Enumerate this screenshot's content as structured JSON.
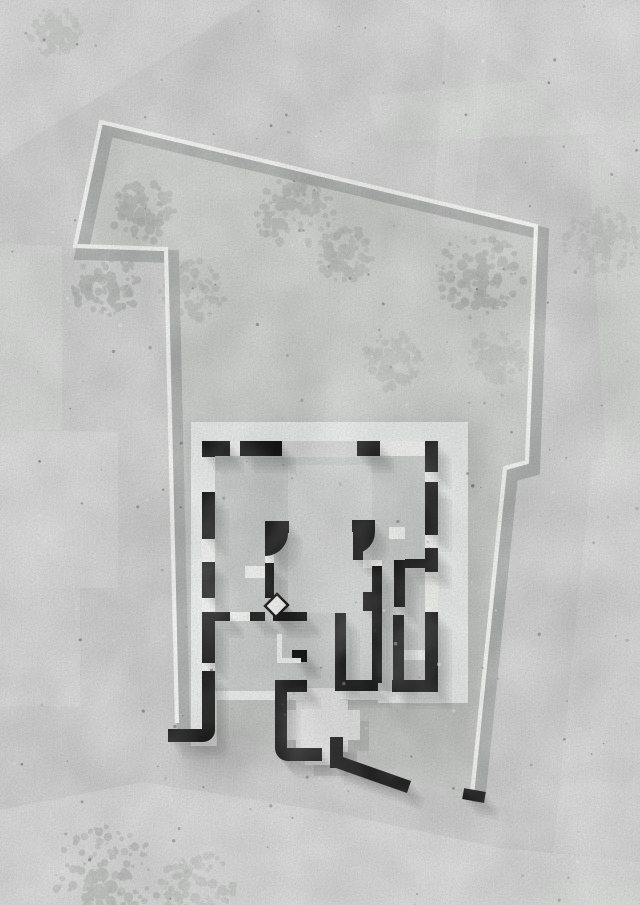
{
  "canvas": {
    "width": 640,
    "height": 905
  },
  "palette": {
    "paper": "#d0d1d0",
    "patch": "#dcdddc",
    "site_tint": "#c5c7c6",
    "halo": "#9e9f9e",
    "tree": "#a4a8a5",
    "tree_dark": "#8f938f",
    "boundary": "#f7f7f5",
    "boundary_shadow": "#a7a9a8",
    "slab": "#ebecec",
    "room": "#c7c9c8",
    "room_light": "#d2d4d3",
    "porch": "#d4d5d4",
    "wall": "#161616",
    "shadow": "#3a3b3a",
    "white": "#f2f2f1",
    "terrace": "#e3e4e3",
    "speckle_dark": "#3a3a3a",
    "speckle_light": "#ffffff"
  },
  "ground": {
    "base": {
      "name": "ground-base"
    },
    "patches": [
      {
        "name": "patch-top-left-plate",
        "pts": "0,0 255,0 0,158",
        "opacity": 0.7
      },
      {
        "name": "patch-top-right-plate",
        "pts": "400,0 640,0 640,195 520,72",
        "opacity": 0.55
      },
      {
        "name": "patch-road-vertical",
        "pts": "447,0 493,0 472,232 432,226",
        "opacity": 0.5
      },
      {
        "name": "patch-road-horizontal",
        "pts": "368,96 640,70 640,132 382,142",
        "opacity": 0.45
      },
      {
        "name": "patch-left-1",
        "pts": "0,244 62,246 62,430 0,430",
        "opacity": 0.6
      },
      {
        "name": "patch-left-2",
        "pts": "0,430 118,432 118,588 0,588",
        "opacity": 0.7
      },
      {
        "name": "patch-left-3",
        "pts": "0,588 80,588 80,706 0,706",
        "opacity": 0.5
      },
      {
        "name": "patch-right-mid",
        "pts": "588,140 640,118 640,450 606,460",
        "opacity": 0.45
      },
      {
        "name": "patch-right-low",
        "pts": "592,460 640,452 640,905 548,905",
        "opacity": 0.5
      },
      {
        "name": "patch-bottom-sweep",
        "pts": "0,810 143,782 330,812 500,848 640,862 640,905 0,905",
        "opacity": 0.8
      },
      {
        "name": "patch-bottom-band",
        "pts": "210,838 640,884 640,905 480,905 196,858",
        "opacity": 0.45
      }
    ]
  },
  "site": {
    "tint_points": "101,122 536,226 527,462 505,468 472,795 177,723 166,249 75,246",
    "tint_opacity": 0.22,
    "halo": {
      "name": "building-ground-halo",
      "r": [
        180,
        425,
        305,
        345
      ],
      "opacity": 0.32
    }
  },
  "trees": [
    {
      "name": "tree-1",
      "cx": 143,
      "cy": 211,
      "r": 33,
      "opacity": 0.5,
      "seed": 11
    },
    {
      "name": "tree-2",
      "cx": 295,
      "cy": 213,
      "r": 40,
      "opacity": 0.45,
      "seed": 23
    },
    {
      "name": "tree-3",
      "cx": 343,
      "cy": 253,
      "r": 30,
      "opacity": 0.4,
      "seed": 31
    },
    {
      "name": "tree-4",
      "cx": 480,
      "cy": 276,
      "r": 45,
      "opacity": 0.5,
      "seed": 47
    },
    {
      "name": "tree-5",
      "cx": 106,
      "cy": 283,
      "r": 36,
      "opacity": 0.5,
      "seed": 53
    },
    {
      "name": "tree-6",
      "cx": 193,
      "cy": 291,
      "r": 33,
      "opacity": 0.38,
      "seed": 61
    },
    {
      "name": "tree-7",
      "cx": 393,
      "cy": 362,
      "r": 31,
      "opacity": 0.32,
      "seed": 71
    },
    {
      "name": "tree-8",
      "cx": 495,
      "cy": 358,
      "r": 29,
      "opacity": 0.28,
      "seed": 83
    },
    {
      "name": "tree-9",
      "cx": 600,
      "cy": 245,
      "r": 38,
      "opacity": 0.22,
      "seed": 97
    },
    {
      "name": "tree-10",
      "cx": 107,
      "cy": 878,
      "r": 54,
      "opacity": 0.42,
      "seed": 101
    },
    {
      "name": "tree-11",
      "cx": 55,
      "cy": 33,
      "r": 26,
      "opacity": 0.22,
      "seed": 113
    },
    {
      "name": "tree-12",
      "cx": 198,
      "cy": 888,
      "r": 38,
      "opacity": 0.3,
      "seed": 127
    }
  ],
  "boundary": {
    "points": "177,723 166,249 75,246 101,122 536,226 527,462 505,468 472,795",
    "width": 4.2,
    "shadow_width": 13,
    "shadow_dx": 6.5,
    "shadow_dy": 7.5,
    "shadow_opacity": 0.85
  },
  "plan": {
    "slabs": [
      {
        "name": "slab-main",
        "r": [
          191,
          422,
          277,
          278
        ]
      },
      {
        "name": "slab-left-extension",
        "r": [
          191,
          694,
          26,
          52
        ]
      },
      {
        "name": "slab-bottom-extension",
        "r": [
          378,
          691,
          90,
          12
        ]
      }
    ],
    "rooms": [
      {
        "name": "interior-floor",
        "r": [
          215,
          456,
          210,
          235
        ],
        "fill": "room",
        "opacity": 1
      },
      {
        "name": "courtyard-floor",
        "r": [
          288,
          465,
          84,
          148
        ],
        "fill": "room_light",
        "opacity": 0.85
      },
      {
        "name": "corridor-floor",
        "r": [
          346,
          613,
          26,
          68
        ],
        "fill": "room_light",
        "opacity": 0.7
      },
      {
        "name": "entry-porch-floor",
        "r": [
          282,
          441,
          75,
          16
        ],
        "fill": "porch",
        "opacity": 1
      }
    ],
    "openings": [
      {
        "name": "window-top-1",
        "r": [
          230,
          441,
          10,
          15
        ]
      },
      {
        "name": "window-top-2",
        "r": [
          380,
          441,
          45,
          15
        ]
      },
      {
        "name": "window-left-1",
        "r": [
          202,
          539,
          13,
          23
        ]
      },
      {
        "name": "window-left-2",
        "r": [
          202,
          598,
          13,
          14
        ]
      },
      {
        "name": "window-left-3",
        "r": [
          202,
          663,
          13,
          8
        ]
      },
      {
        "name": "window-right-1",
        "r": [
          425,
          472,
          13,
          10
        ]
      },
      {
        "name": "window-right-2",
        "r": [
          425,
          535,
          13,
          13
        ]
      },
      {
        "name": "window-right-3",
        "r": [
          425,
          572,
          13,
          40
        ]
      },
      {
        "name": "door-gap-h4",
        "r": [
          230,
          612,
          20,
          9
        ]
      },
      {
        "name": "floor-band-left",
        "r": [
          245,
          566,
          20,
          12
        ]
      },
      {
        "name": "door-gap-v1",
        "r": [
          265,
          553,
          9,
          10
        ]
      },
      {
        "name": "door-gap-v2",
        "r": [
          363,
          560,
          19,
          8
        ]
      },
      {
        "name": "floor-band-right",
        "r": [
          404,
          650,
          21,
          10
        ]
      },
      {
        "name": "door-gap-h2",
        "r": [
          389,
          527,
          16,
          12
        ]
      }
    ],
    "terrace": [
      {
        "name": "terrace-core",
        "r": [
          296,
          700,
          52,
          52
        ]
      },
      {
        "name": "terrace-arm-vertical",
        "r": [
          305,
          688,
          35,
          77
        ]
      },
      {
        "name": "terrace-arm-horizontal",
        "r": [
          284,
          710,
          76,
          30
        ]
      }
    ],
    "terrace_shadow": {
      "dx": 9,
      "dy": 11,
      "opacity": 0.12
    },
    "solids": [
      {
        "name": "top-wall-seg-1",
        "r": [
          204,
          441,
          26,
          15
        ]
      },
      {
        "name": "top-wall-seg-2",
        "r": [
          240,
          441,
          42,
          15
        ]
      },
      {
        "name": "top-wall-seg-3",
        "r": [
          357,
          441,
          23,
          15
        ]
      },
      {
        "name": "left-wall-seg-1",
        "r": [
          202,
          441,
          13,
          16
        ]
      },
      {
        "name": "left-wall-seg-2",
        "r": [
          202,
          492,
          13,
          47
        ]
      },
      {
        "name": "left-wall-seg-3",
        "r": [
          202,
          562,
          13,
          36
        ]
      },
      {
        "name": "left-wall-seg-4",
        "r": [
          202,
          612,
          13,
          51
        ]
      },
      {
        "name": "left-wall-hook",
        "d": "M 202 671 L 215 671 L 215 730 A 12 12 0 0 1 203 742 L 168 742 L 168 729 L 202 729 Z"
      },
      {
        "name": "right-wall-seg-1",
        "r": [
          425,
          441,
          13,
          31
        ]
      },
      {
        "name": "right-wall-seg-2",
        "r": [
          425,
          482,
          13,
          53
        ]
      },
      {
        "name": "right-wall-seg-3",
        "r": [
          425,
          548,
          13,
          24
        ]
      },
      {
        "name": "right-wall-seg-4",
        "r": [
          425,
          612,
          13,
          79
        ]
      },
      {
        "name": "partition-h1",
        "r": [
          265,
          521,
          24,
          12
        ]
      },
      {
        "name": "partition-h2",
        "r": [
          352,
          520,
          23,
          12
        ]
      },
      {
        "name": "partition-h3",
        "r": [
          405,
          559,
          33,
          9
        ]
      },
      {
        "name": "partition-h4a",
        "r": [
          212,
          612,
          18,
          9
        ]
      },
      {
        "name": "partition-h4b",
        "r": [
          250,
          612,
          15,
          9
        ]
      },
      {
        "name": "partition-h5",
        "r": [
          273,
          612,
          34,
          9
        ]
      },
      {
        "name": "corridor-bottom-wall",
        "r": [
          335,
          680,
          43,
          11
        ]
      },
      {
        "name": "right-room-bottom-wall",
        "r": [
          392,
          680,
          46,
          12
        ]
      },
      {
        "name": "door-wedge-left",
        "d": "M 265 533 L 288 533 A 23 23 0 0 1 265 556 Z"
      },
      {
        "name": "door-wedge-right",
        "d": "M 353 532 L 375 532 A 22 22 0 0 1 353 554 Z"
      },
      {
        "name": "partition-v1-stub",
        "r": [
          265,
          533,
          9,
          20
        ]
      },
      {
        "name": "partition-v1",
        "r": [
          265,
          563,
          9,
          35
        ]
      },
      {
        "name": "partition-v2-stub",
        "r": [
          353,
          534,
          10,
          26
        ]
      },
      {
        "name": "partition-v2",
        "r": [
          372,
          566,
          10,
          117
        ]
      },
      {
        "name": "partition-v2-step",
        "r": [
          363,
          592,
          9,
          19
        ]
      },
      {
        "name": "corridor-left-wall",
        "r": [
          335,
          613,
          11,
          68
        ]
      },
      {
        "name": "partition-v4a",
        "r": [
          394,
          560,
          11,
          47
        ]
      },
      {
        "name": "partition-v4b",
        "r": [
          393,
          615,
          11,
          66
        ]
      },
      {
        "name": "bath-wall-stub",
        "r": [
          292,
          650,
          15,
          12
        ]
      },
      {
        "name": "garden-wall-elbow",
        "d": "M 275 680 L 307 680 L 307 692 L 287 692 L 287 748 L 322 748 L 322 761 L 288 761 A 13 13 0 0 1 275 748 Z"
      },
      {
        "name": "garden-wall-diagonal",
        "d": "M 330 737 L 343 737 L 343 757 L 411 781 L 407 793 L 336 768 L 330 768 Z"
      },
      {
        "name": "boundary-end-tick",
        "rot": [
          463,
          790,
          22,
          11,
          10
        ]
      }
    ],
    "shadow_only": [
      {
        "name": "door-leaf-shadow",
        "pts": "265,606 277,594 288,605 276,617"
      }
    ],
    "bath_whites": [
      {
        "name": "bath-wall-white-v",
        "r": [
          277,
          634,
          5,
          29
        ]
      },
      {
        "name": "bath-wall-white-h",
        "r": [
          277,
          658,
          24,
          5
        ]
      }
    ],
    "door_leaf": {
      "name": "door-leaf",
      "pts": "265,606 277,594 288,605 276,617"
    },
    "shadow": {
      "dx": 2.8,
      "dy": 3.4,
      "steps": 5,
      "opacity": 0.055
    }
  },
  "speckles": {
    "dark": {
      "seed": 42,
      "count": 165,
      "rmin": 0.5,
      "rmax": 1.7,
      "omin": 0.12,
      "omax": 0.5
    },
    "light": {
      "seed": 777,
      "count": 65,
      "rmin": 0.6,
      "rmax": 2.0,
      "omin": 0.15,
      "omax": 0.45
    }
  }
}
